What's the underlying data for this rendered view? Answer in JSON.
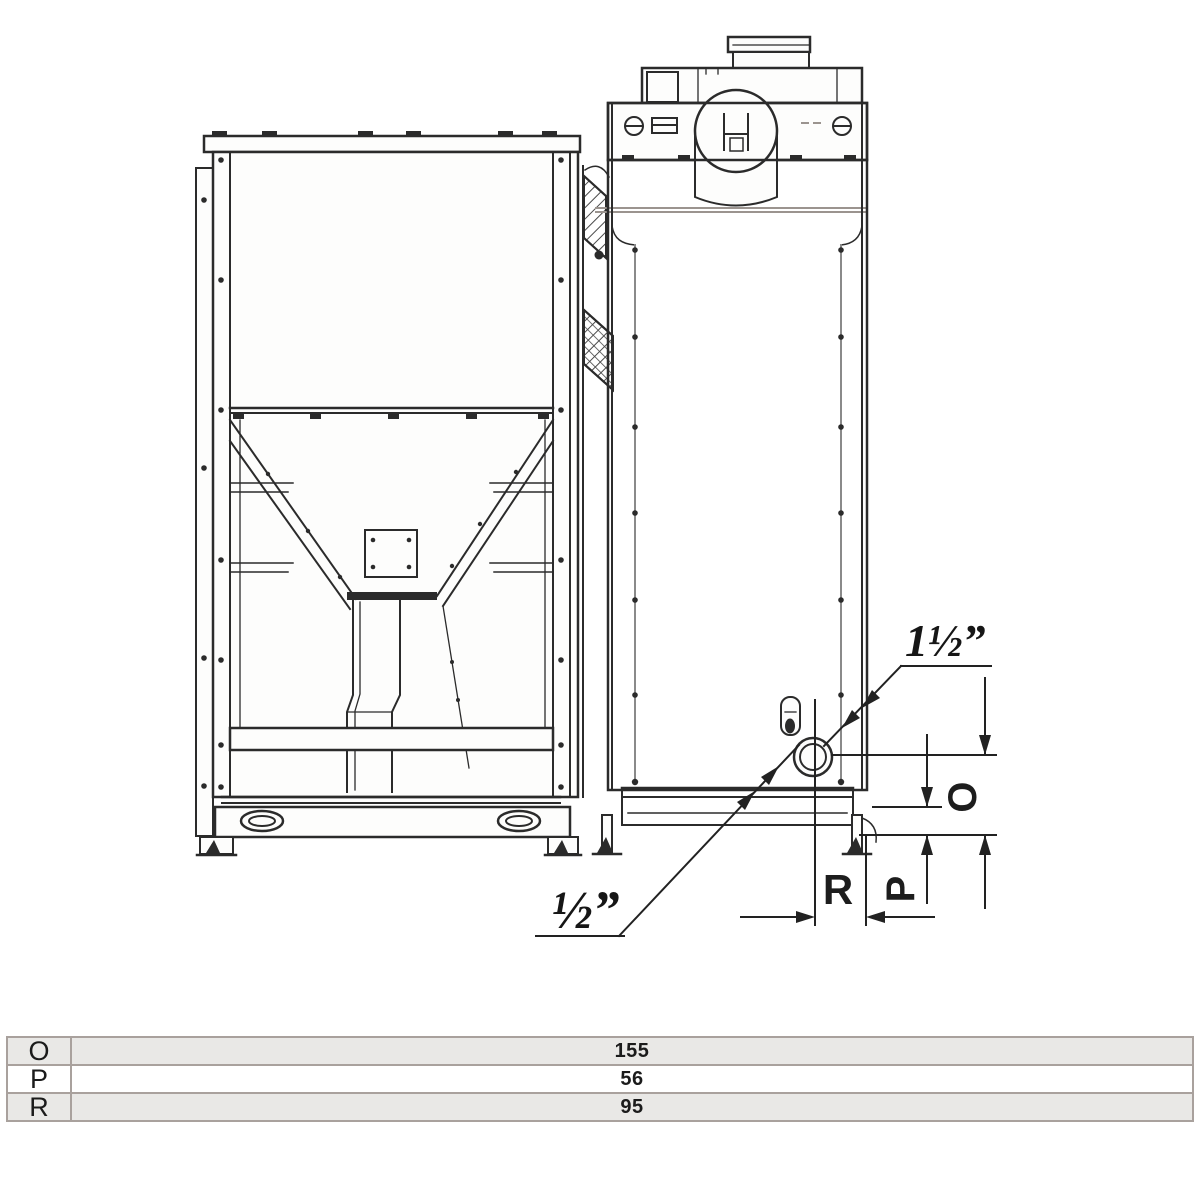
{
  "drawing": {
    "labels": {
      "pipe_large": "1½”",
      "pipe_small": "½”",
      "dim_o": "O",
      "dim_p": "P",
      "dim_r": "R"
    },
    "colors": {
      "line": "#2b2b2b",
      "gray_line": "#9b948f",
      "background": "#ffffff"
    }
  },
  "table": {
    "rows": [
      {
        "label": "O",
        "value": "155"
      },
      {
        "label": "P",
        "value": "56"
      },
      {
        "label": "R",
        "value": "95"
      }
    ],
    "colors": {
      "alt_row": "#e9e8e6",
      "border": "#a9a19d"
    }
  }
}
